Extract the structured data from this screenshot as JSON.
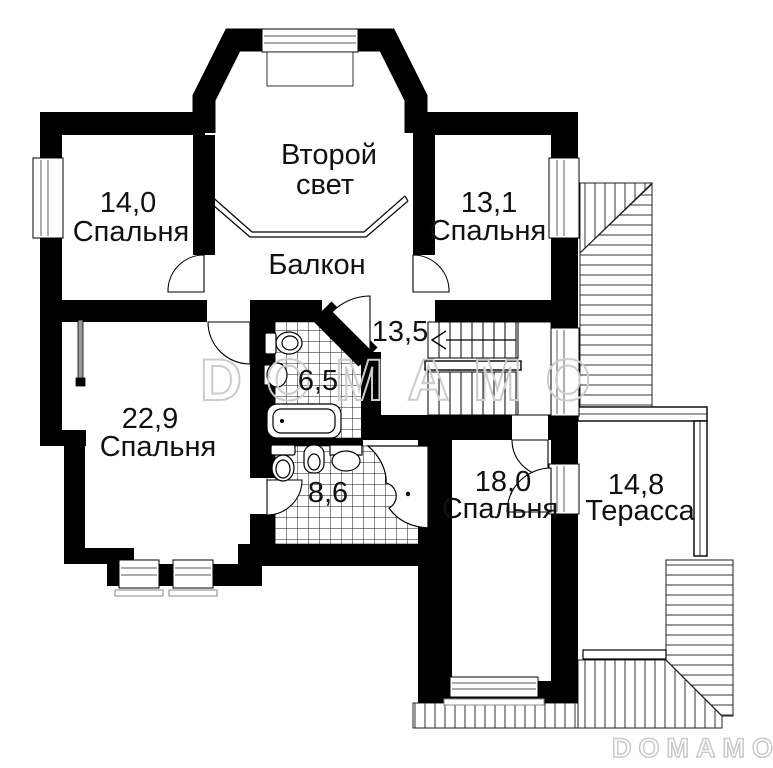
{
  "rooms": {
    "second_light": {
      "line1": "Второй",
      "line2": "свет"
    },
    "bedroom_tl": {
      "area": "14,0",
      "label": "Спальня"
    },
    "bedroom_tr": {
      "area": "13,1",
      "label": "Спальня"
    },
    "balcony": {
      "label": "Балкон"
    },
    "hall": {
      "area": "13,5"
    },
    "bath_small": {
      "area": "6,5"
    },
    "bedroom_left": {
      "area": "22,9",
      "label": "Спальня"
    },
    "bath_big": {
      "area": "8,6"
    },
    "bedroom_bottom": {
      "area": "18,0",
      "label": "Спальня"
    },
    "terrace": {
      "area": "14,8",
      "label": "Терасса"
    }
  },
  "watermarks": {
    "center": "DOMAMO",
    "corner": "DOMAMO"
  },
  "colors": {
    "wall": "#000000",
    "background": "#ffffff",
    "tile_line": "#1a1a1a",
    "hatch_line": "#333333",
    "window_frame": "#777777",
    "watermark": "#cccccc"
  },
  "icons": {
    "bathtub": "bathtub-icon",
    "corner_bathtub": "corner-bathtub-icon",
    "toilet": "toilet-icon",
    "bidet": "bidet-icon",
    "sink": "sink-icon",
    "stairs_arrow": "stairs-direction-arrow-icon"
  }
}
